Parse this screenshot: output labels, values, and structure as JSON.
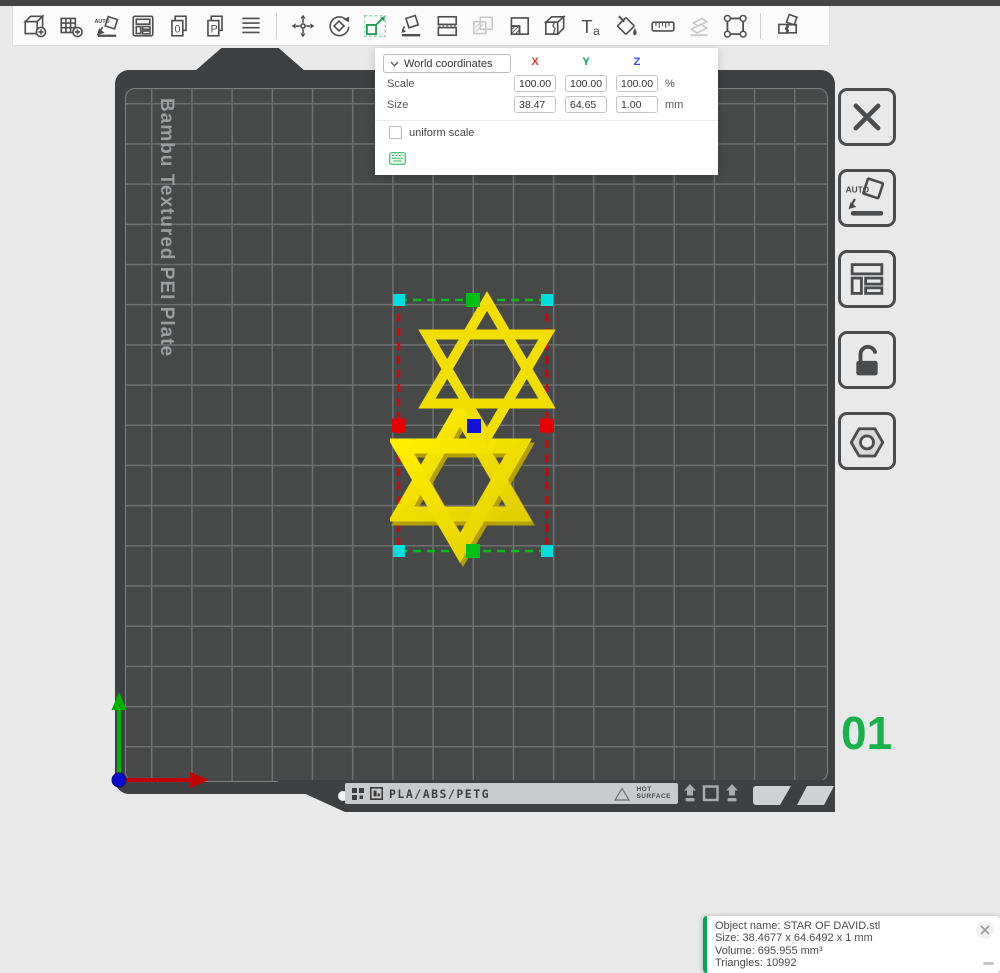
{
  "toolbar": {
    "icons": [
      "add-object",
      "add-plate",
      "auto-orient",
      "arrange",
      "document-0",
      "document-p",
      "layers",
      "move",
      "rotate",
      "scale",
      "place-on-face",
      "split",
      "mirror",
      "variable-layer-height",
      "cut",
      "text",
      "paint",
      "measure",
      "assembly",
      "seam",
      "split-to-parts"
    ],
    "active_icon": "scale",
    "disabled_icons": [
      "mirror",
      "assembly"
    ],
    "glyphs": {
      "auto": "AUTO",
      "zero": "0",
      "p": "P",
      "t": "T",
      "a": "a"
    }
  },
  "scale_panel": {
    "coordinate_dropdown": "World coordinates",
    "axes": [
      {
        "label": "X",
        "color": "#e23a3a"
      },
      {
        "label": "Y",
        "color": "#00a550"
      },
      {
        "label": "Z",
        "color": "#3a4ae2"
      }
    ],
    "scale_row": {
      "label": "Scale",
      "x": "100.00",
      "y": "100.00",
      "z": "100.00",
      "unit": "%"
    },
    "size_row": {
      "label": "Size",
      "x": "38.47",
      "y": "64.65",
      "z": "1.00",
      "unit": "mm"
    },
    "uniform_scale_label": "uniform scale",
    "uniform_scale_checked": false
  },
  "plate": {
    "label": "Bambu Textured PEI Plate",
    "number": "01",
    "number_color": "#18b24b",
    "material_text": "PLA/ABS/PETG",
    "hot_surface_line1": "HOT",
    "hot_surface_line2": "SURFACE"
  },
  "side_toolbar": {
    "buttons": [
      "delete-all",
      "auto-orient",
      "arrange",
      "lock",
      "plate-settings"
    ],
    "auto_glyph": "AUTO"
  },
  "selection": {
    "handle_colors": {
      "corner": "#00dede",
      "y_mid": "#00c014",
      "x_mid": "#e40000",
      "center": "#1212d8"
    },
    "star_color": "#f2e006"
  },
  "object_info": {
    "line1": "Object name: STAR OF DAVID.stl",
    "line2": "Size: 38.4677 x 64.6492 x 1 mm",
    "line3": "Volume: 695.955 mm³",
    "line4": "Triangles: 10992"
  }
}
